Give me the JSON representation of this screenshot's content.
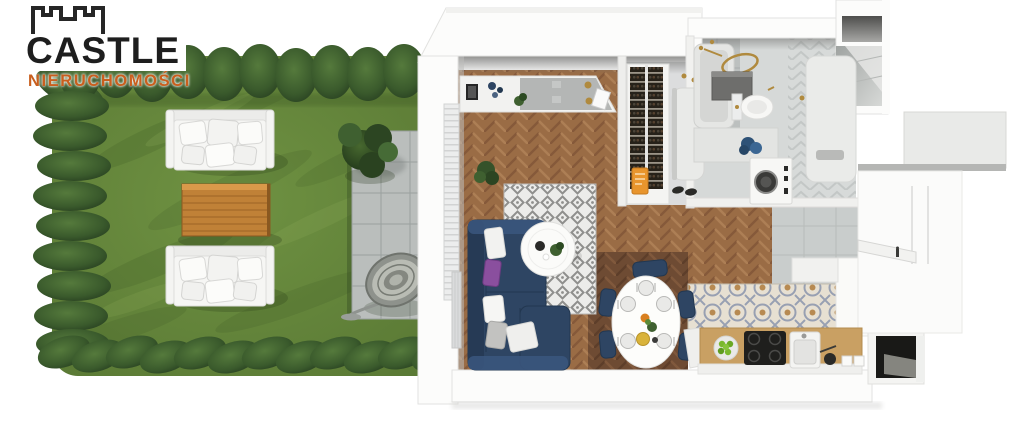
{
  "page": {
    "background": "#ffffff",
    "description": "3D top-down architectural render of a studio apartment with private garden"
  },
  "logo": {
    "brand": "CASTLE",
    "subtitle": "NIERUCHOMOŚCI",
    "brand_color": "#1e1e1e",
    "subtitle_color": "#c95f1e",
    "icon": "castle-battlements-icon"
  },
  "palette": {
    "lawn_green": "#66883c",
    "hedge_green": "#3a5a2c",
    "wood_floor": "#9a6c45",
    "dining_floor_dark": "#6e4b33",
    "sofa_navy": "#2e4563",
    "pillow_purple": "#8a4f9e",
    "terrace_gray": "#babebc",
    "counter_wood": "#c9a063",
    "fixture_gold": "#b08a3e",
    "tile_blue_gray": "#98a0b2",
    "wall_white": "#fbfbfa"
  },
  "scene": {
    "garden": {
      "elements": [
        "hedge-border",
        "lawn",
        "garden-sofa-top",
        "wooden-garden-table",
        "garden-sofa-bottom",
        "paved-terrace",
        "garden-tree",
        "hanging-egg-chair"
      ]
    },
    "apartment": {
      "living_room": [
        "herringbone-wood-floor",
        "sideboard-counter",
        "corner-plant",
        "navy-corner-sofa",
        "throw-pillows",
        "round-coffee-table",
        "diamond-pattern-rug",
        "balcony-door",
        "radiator"
      ],
      "dining_area": [
        "oval-dining-table",
        "navy-dining-chairs",
        "table-settings",
        "dark-wood-floor"
      ],
      "kitchen": [
        "patterned-tile-floor",
        "wooden-countertop",
        "induction-cooktop",
        "kitchen-sink",
        "fruit-bowl",
        "upper-cabinets"
      ],
      "bathroom": [
        "shower-tray",
        "gold-shower-head",
        "storage-box",
        "toilet",
        "washing-machine",
        "vanity-counter",
        "blue-towel",
        "chevron-tiles"
      ],
      "hallway": [
        "wine-rack",
        "bench",
        "coat-hooks",
        "shoes",
        "entrance-door",
        "gray-tile-floor"
      ]
    }
  }
}
